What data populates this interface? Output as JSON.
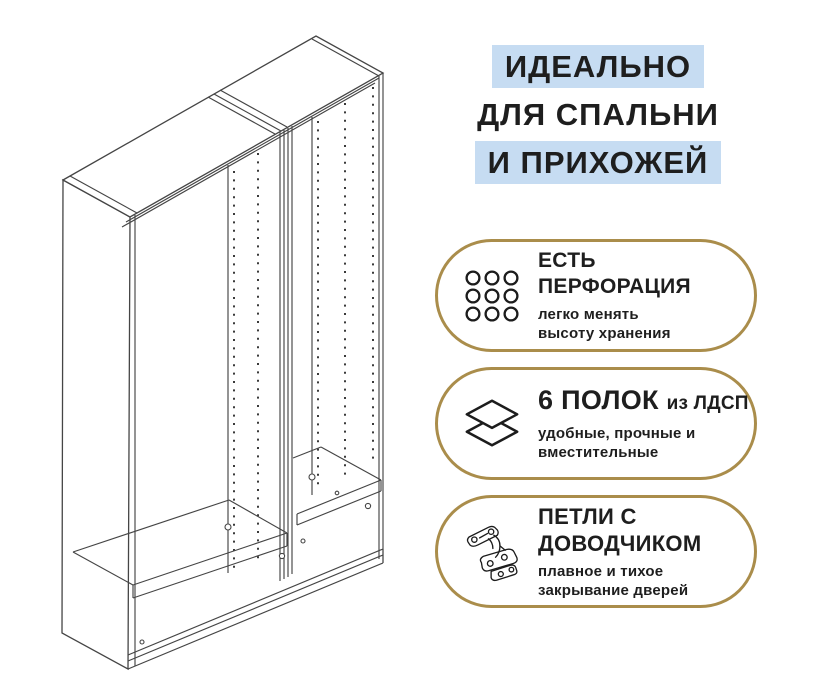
{
  "title": {
    "line1": "ИДЕАЛЬНО",
    "line2": "ДЛЯ СПАЛЬНИ",
    "line3": "И ПРИХОЖЕЙ"
  },
  "features": [
    {
      "icon": "perforation-grid-icon",
      "heading_line1": "ЕСТЬ",
      "heading_line2": "ПЕРФОРАЦИЯ",
      "sub_line1": "легко менять",
      "sub_line2": "высоту хранения"
    },
    {
      "icon": "shelf-layers-icon",
      "heading_main": "6 ПОЛОК",
      "heading_suffix": "из ЛДСП",
      "sub_line1": "удобные, прочные и",
      "sub_line2": "вместительные"
    },
    {
      "icon": "hinge-icon",
      "heading_line1": "ПЕТЛИ С",
      "heading_line2": "ДОВОДЧИКОМ",
      "sub_line1": "плавное и тихое",
      "sub_line2": "закрывание дверей"
    }
  ],
  "colors": {
    "highlight_blue": "#c6dcf2",
    "badge_border_gold": "#aa8d4b",
    "text_dark": "#1e1e1e",
    "drawing_line": "#454545"
  }
}
